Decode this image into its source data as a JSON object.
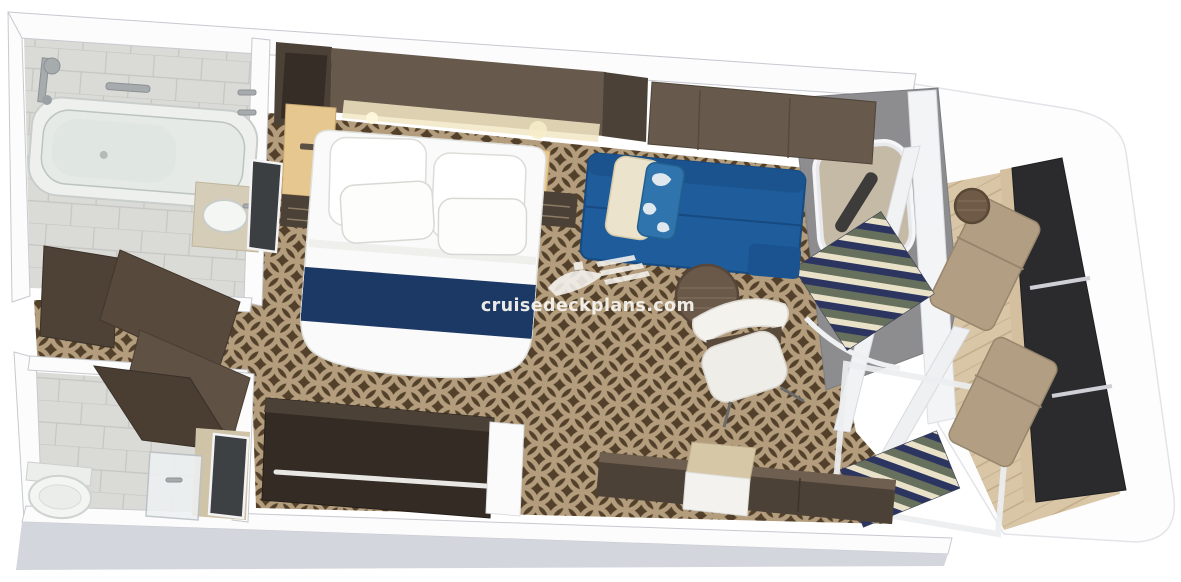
{
  "watermark": {
    "text": "cruisedeckplans.com",
    "icon": "cruise-ship-icon"
  },
  "colors": {
    "page_bg": "#ffffff",
    "wall_top": "#fcfcfd",
    "wall_side": "#d3d6dd",
    "wall_stroke": "#c7c9cf",
    "carpet_base": "#52402b",
    "carpet_line": "#b39d7d",
    "tile_floor": "#dadbd7",
    "tile_line": "#c5c6c2",
    "bed_white": "#fafafa",
    "bed_accent": "#1c3864",
    "sofa_blue": "#1e5c9c",
    "wood_dark": "#4c4137",
    "wood_mid": "#675a4d",
    "wood_light": "#e5c78f",
    "balcony_wood": "#d8c6a7",
    "balcony_wood_line": "#c2ab87",
    "partition_gray": "#8d8d90",
    "railing_dark": "#2b2b2e",
    "cushion_tan": "#b29f83",
    "stripe_navy": "#2c3560",
    "stripe_cream": "#e9e2c9",
    "stripe_olive": "#67705c",
    "pillow_cream": "#ece3cd",
    "pillow_blue": "#2f74ac",
    "watermark": "#f6f4ef"
  }
}
